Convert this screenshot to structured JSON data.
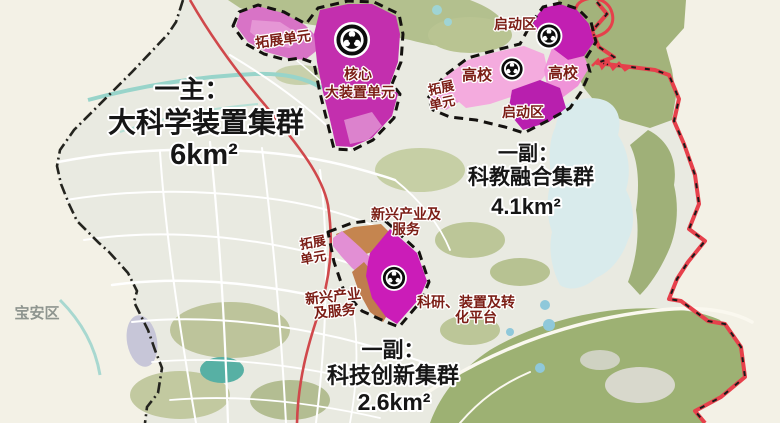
{
  "map": {
    "district_label": "宝安区",
    "clusters": {
      "main": {
        "prefix": "一主：",
        "name": "大科学装置集群",
        "area": "6km²",
        "zone_expansion": "拓展单元",
        "zone_core_line1": "核心",
        "zone_core_line2": "大装置单元"
      },
      "northeast": {
        "prefix": "一副：",
        "name": "科教融合集群",
        "area": "4.1km²",
        "zone_startup_top": "启动区",
        "zone_university_west": "高校",
        "zone_university_east": "高校",
        "zone_startup_south": "启动区",
        "zone_expansion_line1": "拓展",
        "zone_expansion_line2": "单元"
      },
      "south": {
        "prefix": "一副：",
        "name": "科技创新集群",
        "area": "2.6km²",
        "zone_industry_north_line1": "新兴产业及",
        "zone_industry_north_line2": "服务",
        "zone_expansion_line1": "拓展",
        "zone_expansion_line2": "单元",
        "zone_industry_west_line1": "新兴产业",
        "zone_industry_west_line2": "及服务",
        "zone_platform_line1": "科研、装置及转",
        "zone_platform_line2": "化平台"
      }
    },
    "icons": {
      "science_device": "science-device-icon"
    },
    "colors": {
      "core_magenta": "#c32fae",
      "bright_magenta": "#cb1cb8",
      "startup_magenta": "#bc1fb0",
      "light_pink": "#f4abde",
      "mid_pink": "#e28fd4",
      "industry_brown": "#c5854f",
      "zone_label_maroon": "#7b1d15",
      "title_black": "#161616",
      "boundary_red": "#e6404b",
      "forest_green": "#a3b37b",
      "lake_blue": "#d9ebec",
      "river_teal": "#8fd1c8",
      "urban_gray": "#e9eae1",
      "outside_cream": "#f3f1e6"
    }
  }
}
